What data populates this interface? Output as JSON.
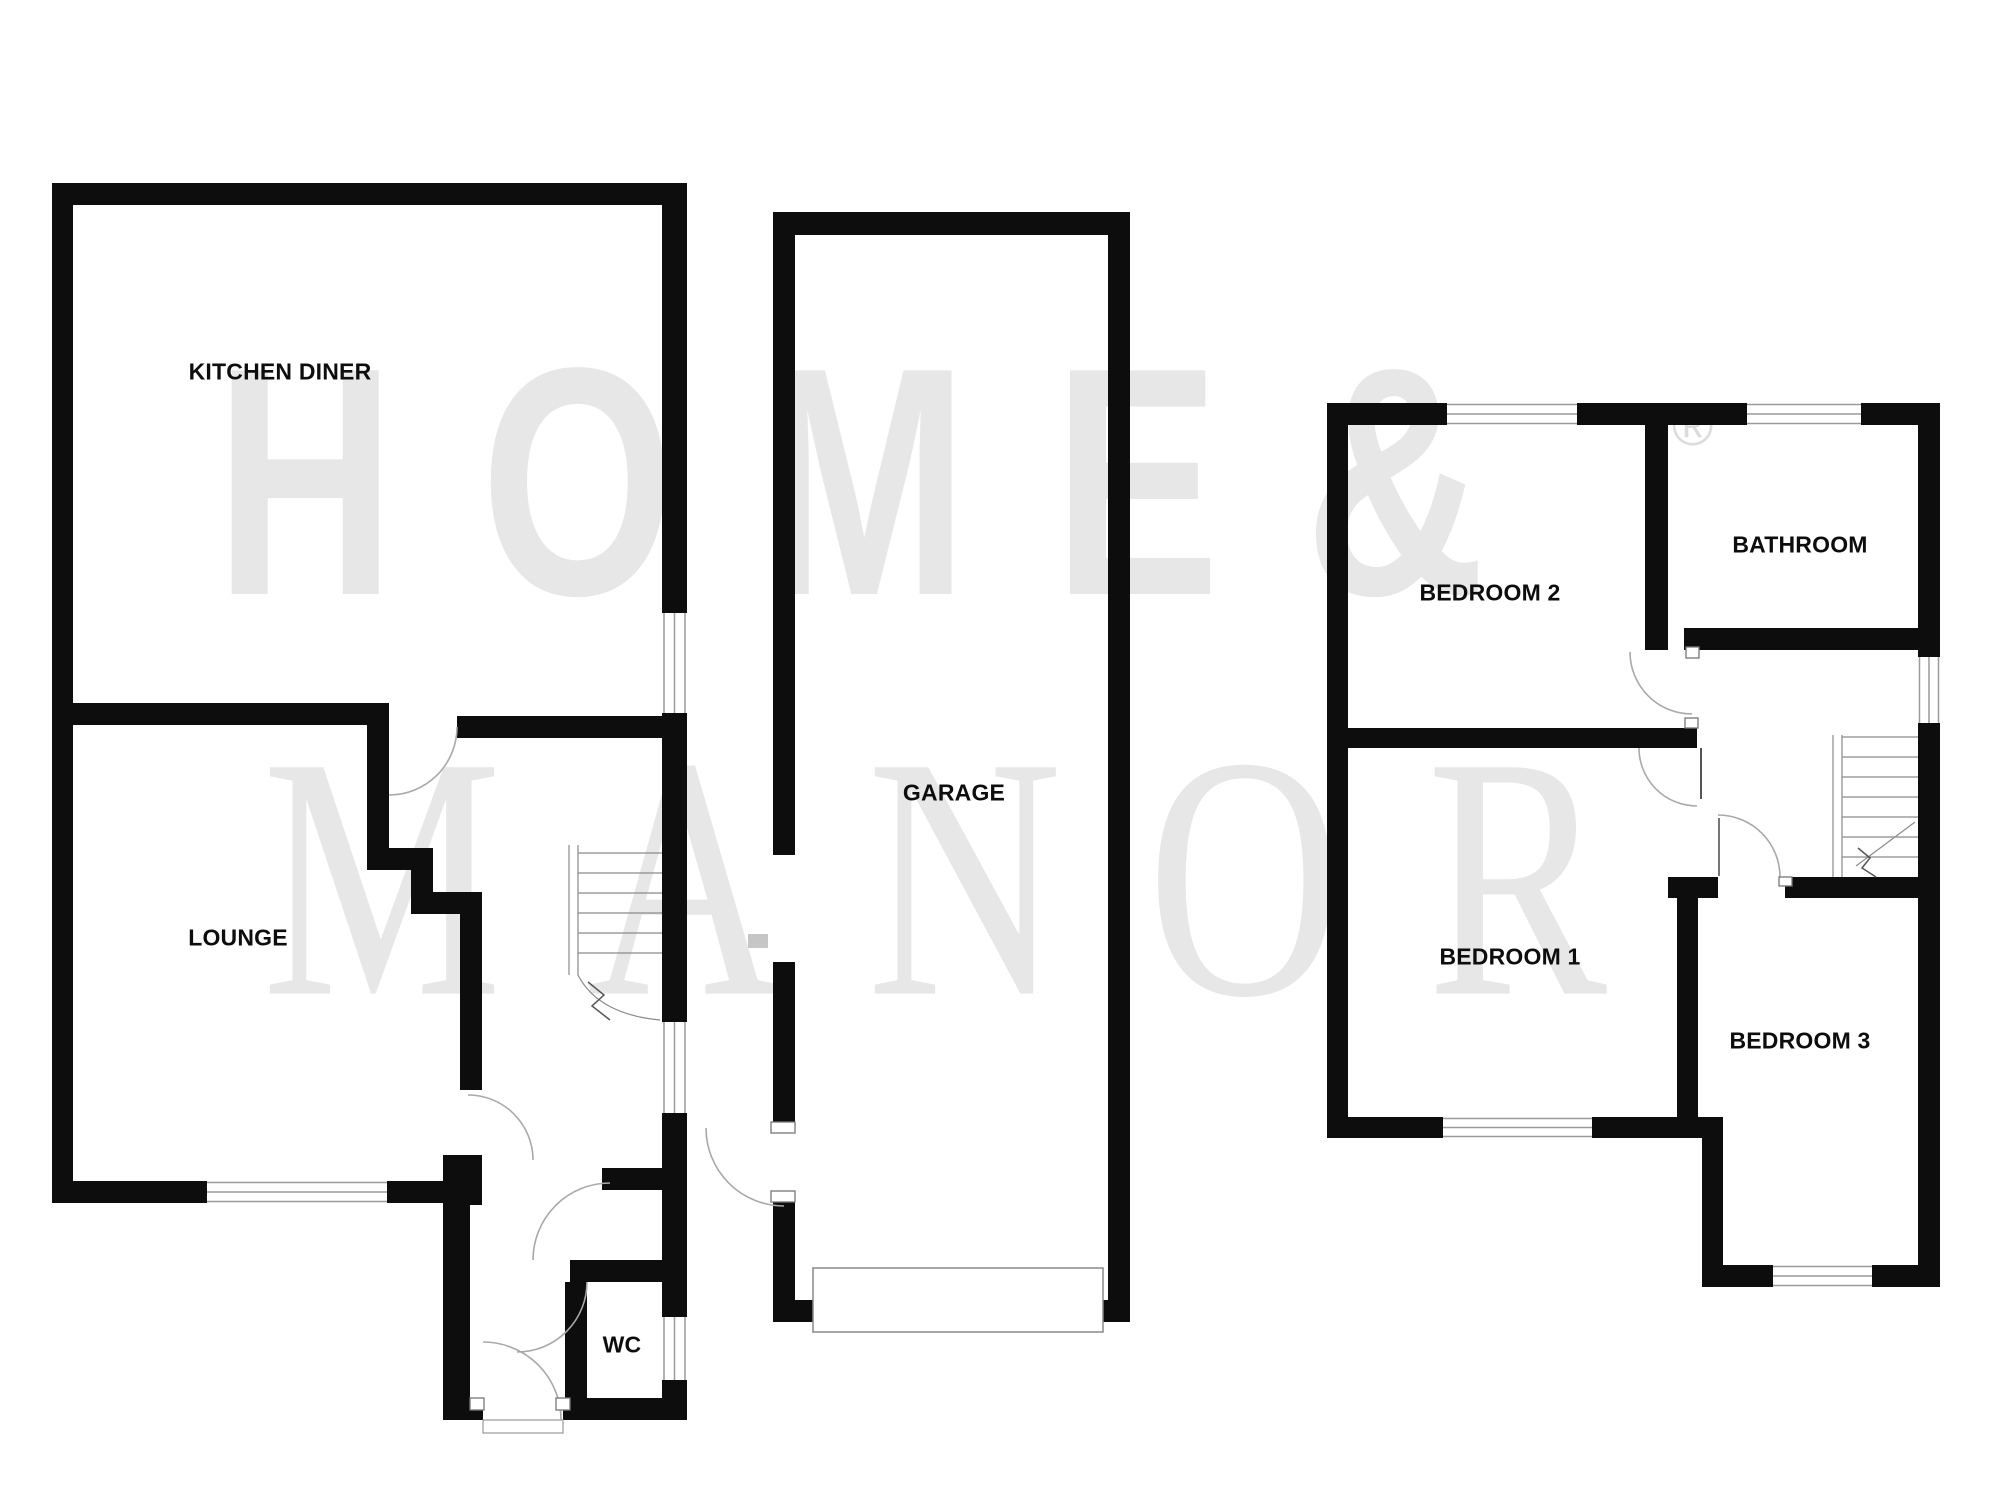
{
  "watermark": {
    "line1": "HOME&",
    "line2": "MANOR",
    "registered_symbol": "®",
    "color": "#e7e7e7"
  },
  "floorplan": {
    "ground_floor": {
      "kitchen_diner": "KITCHEN DINER",
      "lounge": "LOUNGE",
      "wc": "WC",
      "garage": "GARAGE"
    },
    "first_floor": {
      "bedroom2": "BEDROOM 2",
      "bathroom": "BATHROOM",
      "bedroom1": "BEDROOM 1",
      "bedroom3": "BEDROOM 3"
    }
  },
  "colors": {
    "walls": "#0d0d0d",
    "thin_lines": "#a9a9a9",
    "labels": "#0d0d0d",
    "background": "#ffffff"
  }
}
